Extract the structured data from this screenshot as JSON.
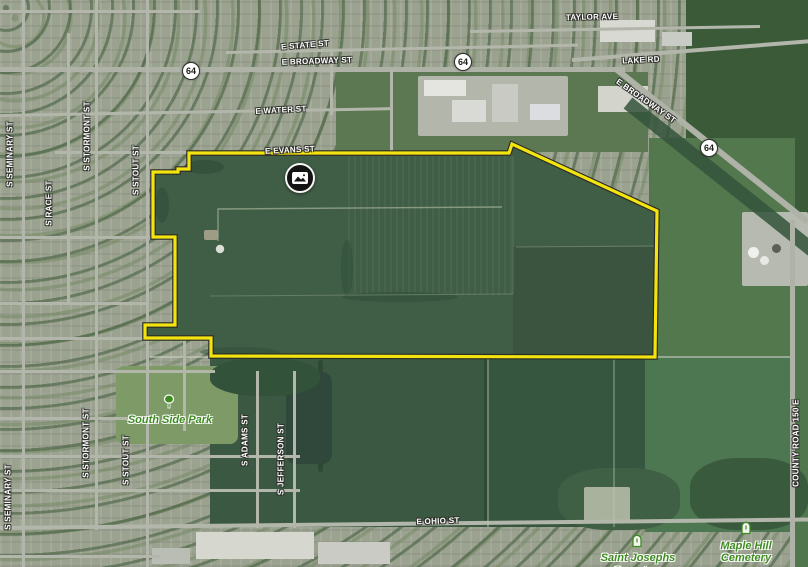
{
  "streets": {
    "taylor_ave": "TAYLOR AVE",
    "e_state_st": "E STATE ST",
    "e_broadway_st": "E BROADWAY ST",
    "lake_rd": "LAKE RD",
    "e_water_st": "E WATER ST",
    "e_evans_st": "E EVANS ST",
    "e_ohio_st": "E OHIO ST",
    "s_seminary_st": "S SEMINARY ST",
    "s_race_st": "S RACE ST",
    "s_stormont_st": "S STORMONT ST",
    "s_stout_st": "S STOUT ST",
    "s_adams_st": "S ADAMS ST",
    "s_jefferson_st": "S JEFFERSON ST",
    "county_road_150_e": "COUNTY ROAD 150 E"
  },
  "route_shield": {
    "label": "64"
  },
  "landmarks": {
    "south_side_park": "South Side Park",
    "saint_josephs_line1": "Saint Josephs",
    "saint_josephs_line2": "Cemetery",
    "maple_hill_line1": "Maple Hill",
    "maple_hill_line2": "Cemetery"
  },
  "boundary": {
    "color": "#f3e410",
    "outline_color": "#2a2a26",
    "points": "189,153 509,153 512,144 657,211 655,357 211,356 211,338 145,338 145,325 175,325 175,237 153,237 153,172 178,172 178,169 189,169"
  },
  "colors": {
    "field_dark_green": "#405d46",
    "label_green": "#3e8b22",
    "road_gray": "#b3b7ab"
  },
  "marker": {
    "icon": "photo-icon"
  }
}
